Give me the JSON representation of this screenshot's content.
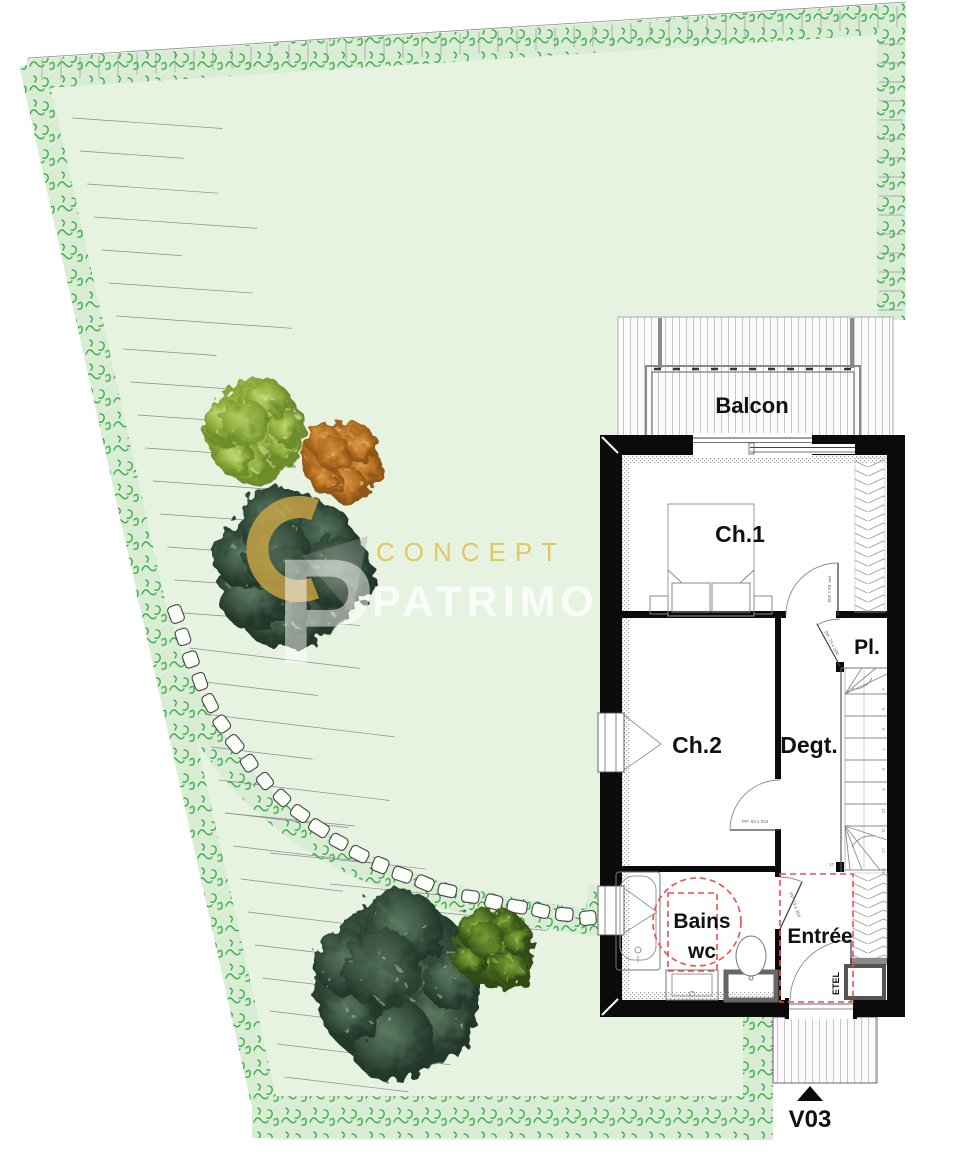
{
  "plan": {
    "rooms": {
      "balcon": "Balcon",
      "ch1": "Ch.1",
      "pl": "Pl.",
      "ch2": "Ch.2",
      "degt": "Degt.",
      "bains_line1": "Bains",
      "bains_line2": "wc",
      "entree": "Entrée",
      "etel": "ETEL",
      "v03": "V03"
    },
    "door_labels": {
      "ch1_door": "PP: 83 x 204",
      "pl_door": "PP: 73 x 204",
      "ch2_door": "PP: 83 x 204",
      "bath_door": "PP: 73 x 204"
    },
    "stairs": {
      "numbers": [
        "4",
        "5",
        "6",
        "7",
        "8",
        "9",
        "10",
        "11",
        "12",
        "13"
      ],
      "last_step": "17"
    }
  },
  "watermark": {
    "word1": "CONCEPT",
    "word2": "PATRIMO",
    "logo_letter": "P"
  },
  "colors": {
    "garden": "#e7f3e1",
    "band": "#d9ecd4",
    "hedge": "#2fa83c",
    "wall": "#0b0b0b",
    "red": "#f14c4c",
    "gold": "#c9a545",
    "gold_text": "#e4c45c"
  }
}
